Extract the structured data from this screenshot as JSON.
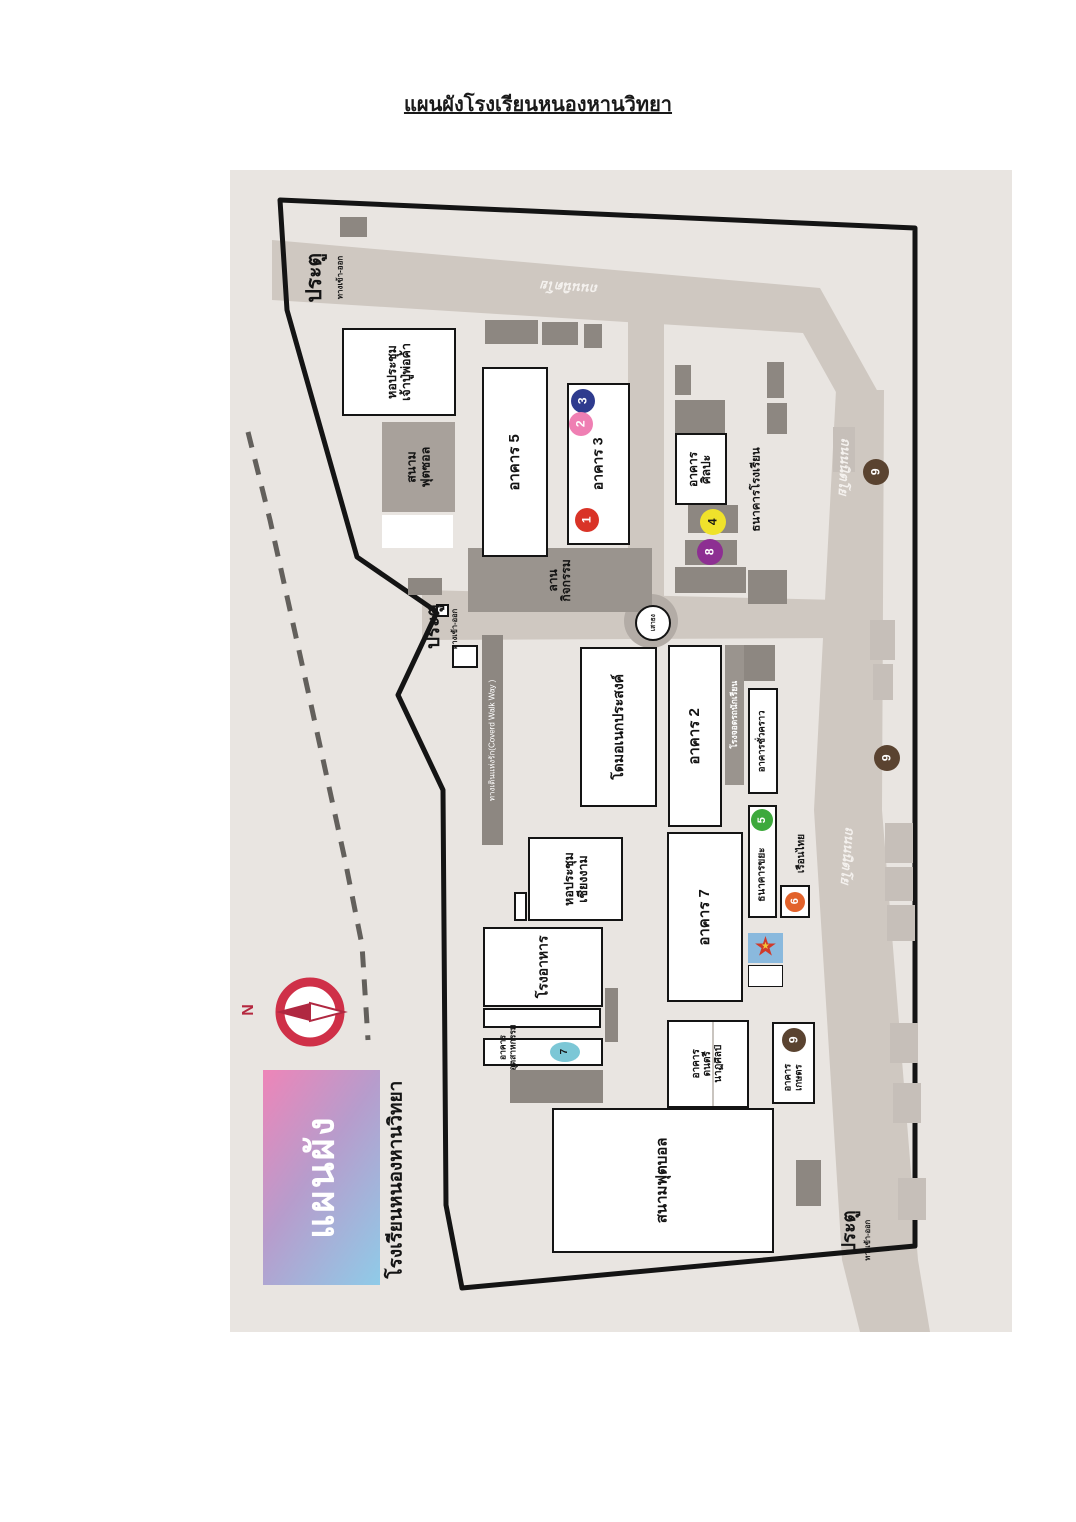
{
  "page": {
    "title": "แผนผังโรงเรียนหนองหานวิทยา"
  },
  "map": {
    "road_name": "ถนนนิตโย",
    "gate_label": "ประตู",
    "gate_sublabel": "ทางเข้า-ออก",
    "compass": {
      "north": "N"
    },
    "banner": {
      "word": "แผนผัง",
      "school": "โรงเรียนหนองหานวิทยา"
    },
    "places": {
      "hall_chaopu": {
        "l1": "หอประชุม",
        "l2": "เจ้าปู่พ่อค้า"
      },
      "futsal": {
        "l1": "สนาม",
        "l2": "ฟุตซอล"
      },
      "b5": {
        "label": "อาคาร 5"
      },
      "b3": {
        "label": "อาคาร 3"
      },
      "art": {
        "l1": "อาคาร",
        "l2": "ศิลปะ"
      },
      "school_bank": {
        "label": "ธนาคารโรงเรียน"
      },
      "plaza": {
        "l1": "ลาน",
        "l2": "กิจกรรม"
      },
      "flagpole": {
        "label": "เสาธง"
      },
      "walkway": {
        "label": "ทางเดินแห่งรัก(Coverd Walk Way )"
      },
      "dome": {
        "label": "โดมอเนกประสงค์"
      },
      "b2": {
        "label": "อาคาร 2"
      },
      "parking": {
        "label": "โรงจอดรถนักเรียน"
      },
      "temp": {
        "label": "อาคารชั่วคราว"
      },
      "waste_bank": {
        "label": "ธนาคารขยะ"
      },
      "thai_house": {
        "label": "เรือนไทย"
      },
      "b7": {
        "label": "อาคาร 7"
      },
      "hall_chiangngam": {
        "l1": "หอประชุม",
        "l2": "เชียงงาม"
      },
      "cafeteria": {
        "label": "โรงอาหาร"
      },
      "industry": {
        "l1": "อาคาร",
        "l2": "อุตสาหกรรม"
      },
      "music": {
        "l1": "อาคาร",
        "l2": "ดนตรี",
        "l3": "นาฏศิลป์"
      },
      "agri": {
        "l1": "อาคาร",
        "l2": "เกษตร"
      },
      "football": {
        "label": "สนามฟุตบอล"
      }
    },
    "markers": {
      "m1": {
        "n": "1",
        "color": "#d93327"
      },
      "m2": {
        "n": "2",
        "color": "#ef7fb3"
      },
      "m3": {
        "n": "3",
        "color": "#2e3b8e"
      },
      "m4": {
        "n": "4",
        "color": "#efe22b"
      },
      "m5": {
        "n": "5",
        "color": "#3da93c"
      },
      "m6": {
        "n": "6",
        "color": "#e2622b"
      },
      "m7": {
        "n": "7",
        "color": "#7cc7d6"
      },
      "m8": {
        "n": "8",
        "color": "#8d2f92"
      },
      "m9": {
        "n": "9",
        "color": "#5a4330"
      }
    },
    "colors": {
      "map_bg": "#e9e5e1",
      "road": "#cfc8c1",
      "boundary": "#141414",
      "shed": "#8d8781",
      "plaza": "#9a948e",
      "compass_red": "#cf3048",
      "banner_pink": "#ee85b8",
      "banner_blue": "#8fcbe8",
      "star_bg": "#8ab9dd"
    }
  }
}
